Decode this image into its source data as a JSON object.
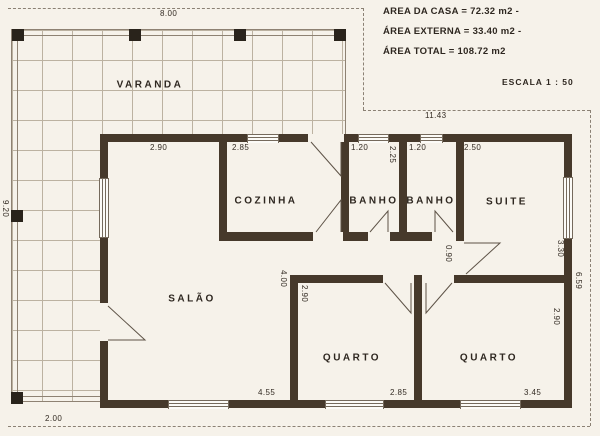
{
  "colors": {
    "paper": "#f6f2ea",
    "wall": "#46392b",
    "grid": "#b3a795",
    "ink": "#2e2720",
    "line": "#5e5347",
    "boundary": "#8b8174"
  },
  "notes": {
    "line1": "AREA DA CASA = 72.32 m2 -",
    "line2": "ÁREA EXTERNA = 33.40 m2 -",
    "line3": "ÁREA TOTAL = 108.72 m2",
    "scale": "ESCALA 1 : 50"
  },
  "rooms": [
    {
      "label": "VARANDA",
      "cx": 150,
      "cy": 85
    },
    {
      "label": "COZINHA",
      "cx": 266,
      "cy": 201
    },
    {
      "label": "BANHO",
      "cx": 374,
      "cy": 201
    },
    {
      "label": "BANHO",
      "cx": 431,
      "cy": 201
    },
    {
      "label": "SUITE",
      "cx": 507,
      "cy": 202
    },
    {
      "label": "SALÃO",
      "cx": 192,
      "cy": 299
    },
    {
      "label": "QUARTO",
      "cx": 352,
      "cy": 358
    },
    {
      "label": "QUARTO",
      "cx": 489,
      "cy": 358
    }
  ],
  "dimensions": [
    {
      "text": "8.00",
      "x": 160,
      "y": 10,
      "vert": false
    },
    {
      "text": "11.43",
      "x": 425,
      "y": 112,
      "vert": false
    },
    {
      "text": "2.90",
      "x": 150,
      "y": 144,
      "vert": false
    },
    {
      "text": "2.85",
      "x": 232,
      "y": 144,
      "vert": false
    },
    {
      "text": "1.20",
      "x": 351,
      "y": 144,
      "vert": false
    },
    {
      "text": "2.25",
      "x": 388,
      "y": 146,
      "vert": true
    },
    {
      "text": "1.20",
      "x": 409,
      "y": 144,
      "vert": false
    },
    {
      "text": "2.50",
      "x": 464,
      "y": 144,
      "vert": false
    },
    {
      "text": "9.20",
      "x": 1,
      "y": 200,
      "vert": true
    },
    {
      "text": "4.00",
      "x": 279,
      "y": 270,
      "vert": true
    },
    {
      "text": "2.90",
      "x": 300,
      "y": 285,
      "vert": true
    },
    {
      "text": "0.90",
      "x": 444,
      "y": 245,
      "vert": true
    },
    {
      "text": "3.30",
      "x": 556,
      "y": 240,
      "vert": true
    },
    {
      "text": "6.59",
      "x": 574,
      "y": 272,
      "vert": true
    },
    {
      "text": "2.90",
      "x": 552,
      "y": 308,
      "vert": true
    },
    {
      "text": "2.00",
      "x": 45,
      "y": 415,
      "vert": false
    },
    {
      "text": "4.55",
      "x": 258,
      "y": 389,
      "vert": false
    },
    {
      "text": "2.85",
      "x": 390,
      "y": 389,
      "vert": false
    },
    {
      "text": "3.45",
      "x": 524,
      "y": 389,
      "vert": false
    }
  ]
}
